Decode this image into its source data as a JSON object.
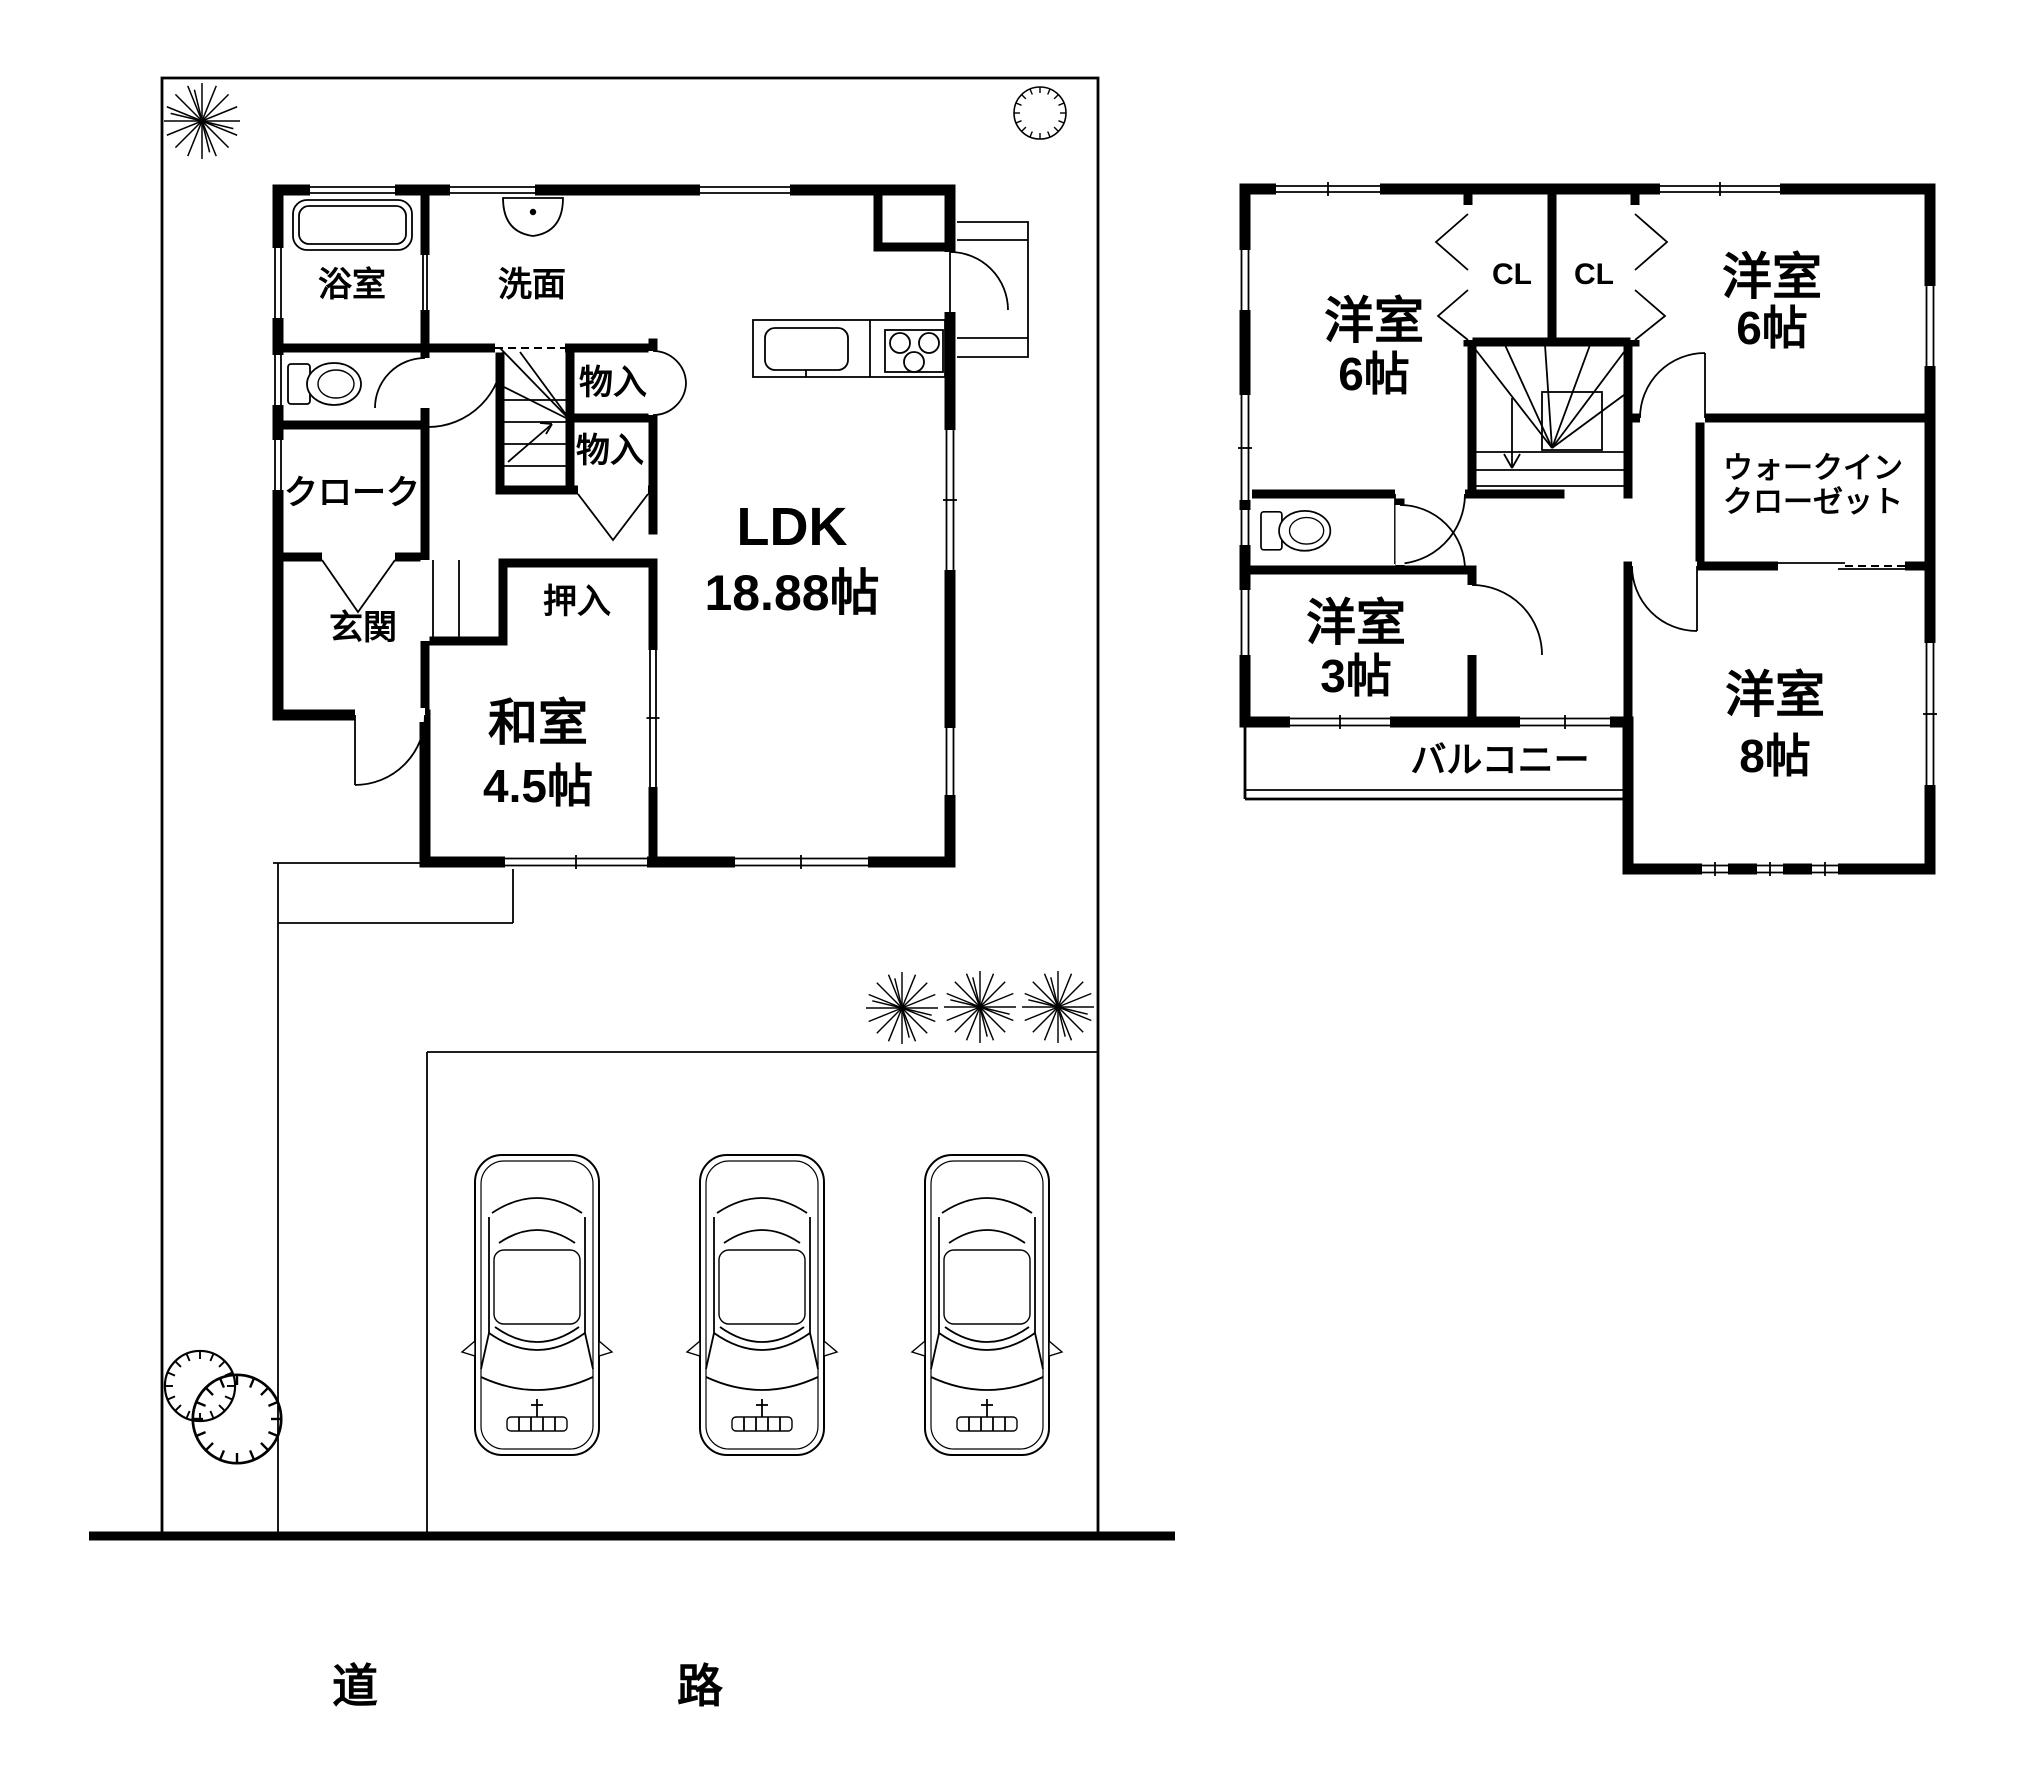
{
  "colors": {
    "ink": "#000000",
    "paper": "#ffffff"
  },
  "floor1": {
    "bath": "浴室",
    "washstand": "洗面",
    "storage_upper": "物入",
    "storage_lower": "物入",
    "cloak": "クローク",
    "entrance": "玄関",
    "futon_closet": "押入",
    "tatami_room": {
      "name": "和室",
      "size": "4.5帖"
    },
    "ldk": {
      "name": "LDK",
      "size": "18.88帖"
    }
  },
  "floor2": {
    "west_room": {
      "name": "洋室",
      "size": "6帖"
    },
    "closet_left": "CL",
    "closet_right": "CL",
    "northeast_room": {
      "name": "洋室",
      "size": "6帖"
    },
    "walkin_closet": {
      "line1": "ウォークイン",
      "line2": "クローゼット"
    },
    "small_room": {
      "name": "洋室",
      "size": "3帖"
    },
    "balcony": "バルコニー",
    "southeast_room": {
      "name": "洋室",
      "size": "8帖"
    }
  },
  "site": {
    "road": {
      "char1": "道",
      "char2": "路"
    },
    "parking_car_count": 3
  }
}
